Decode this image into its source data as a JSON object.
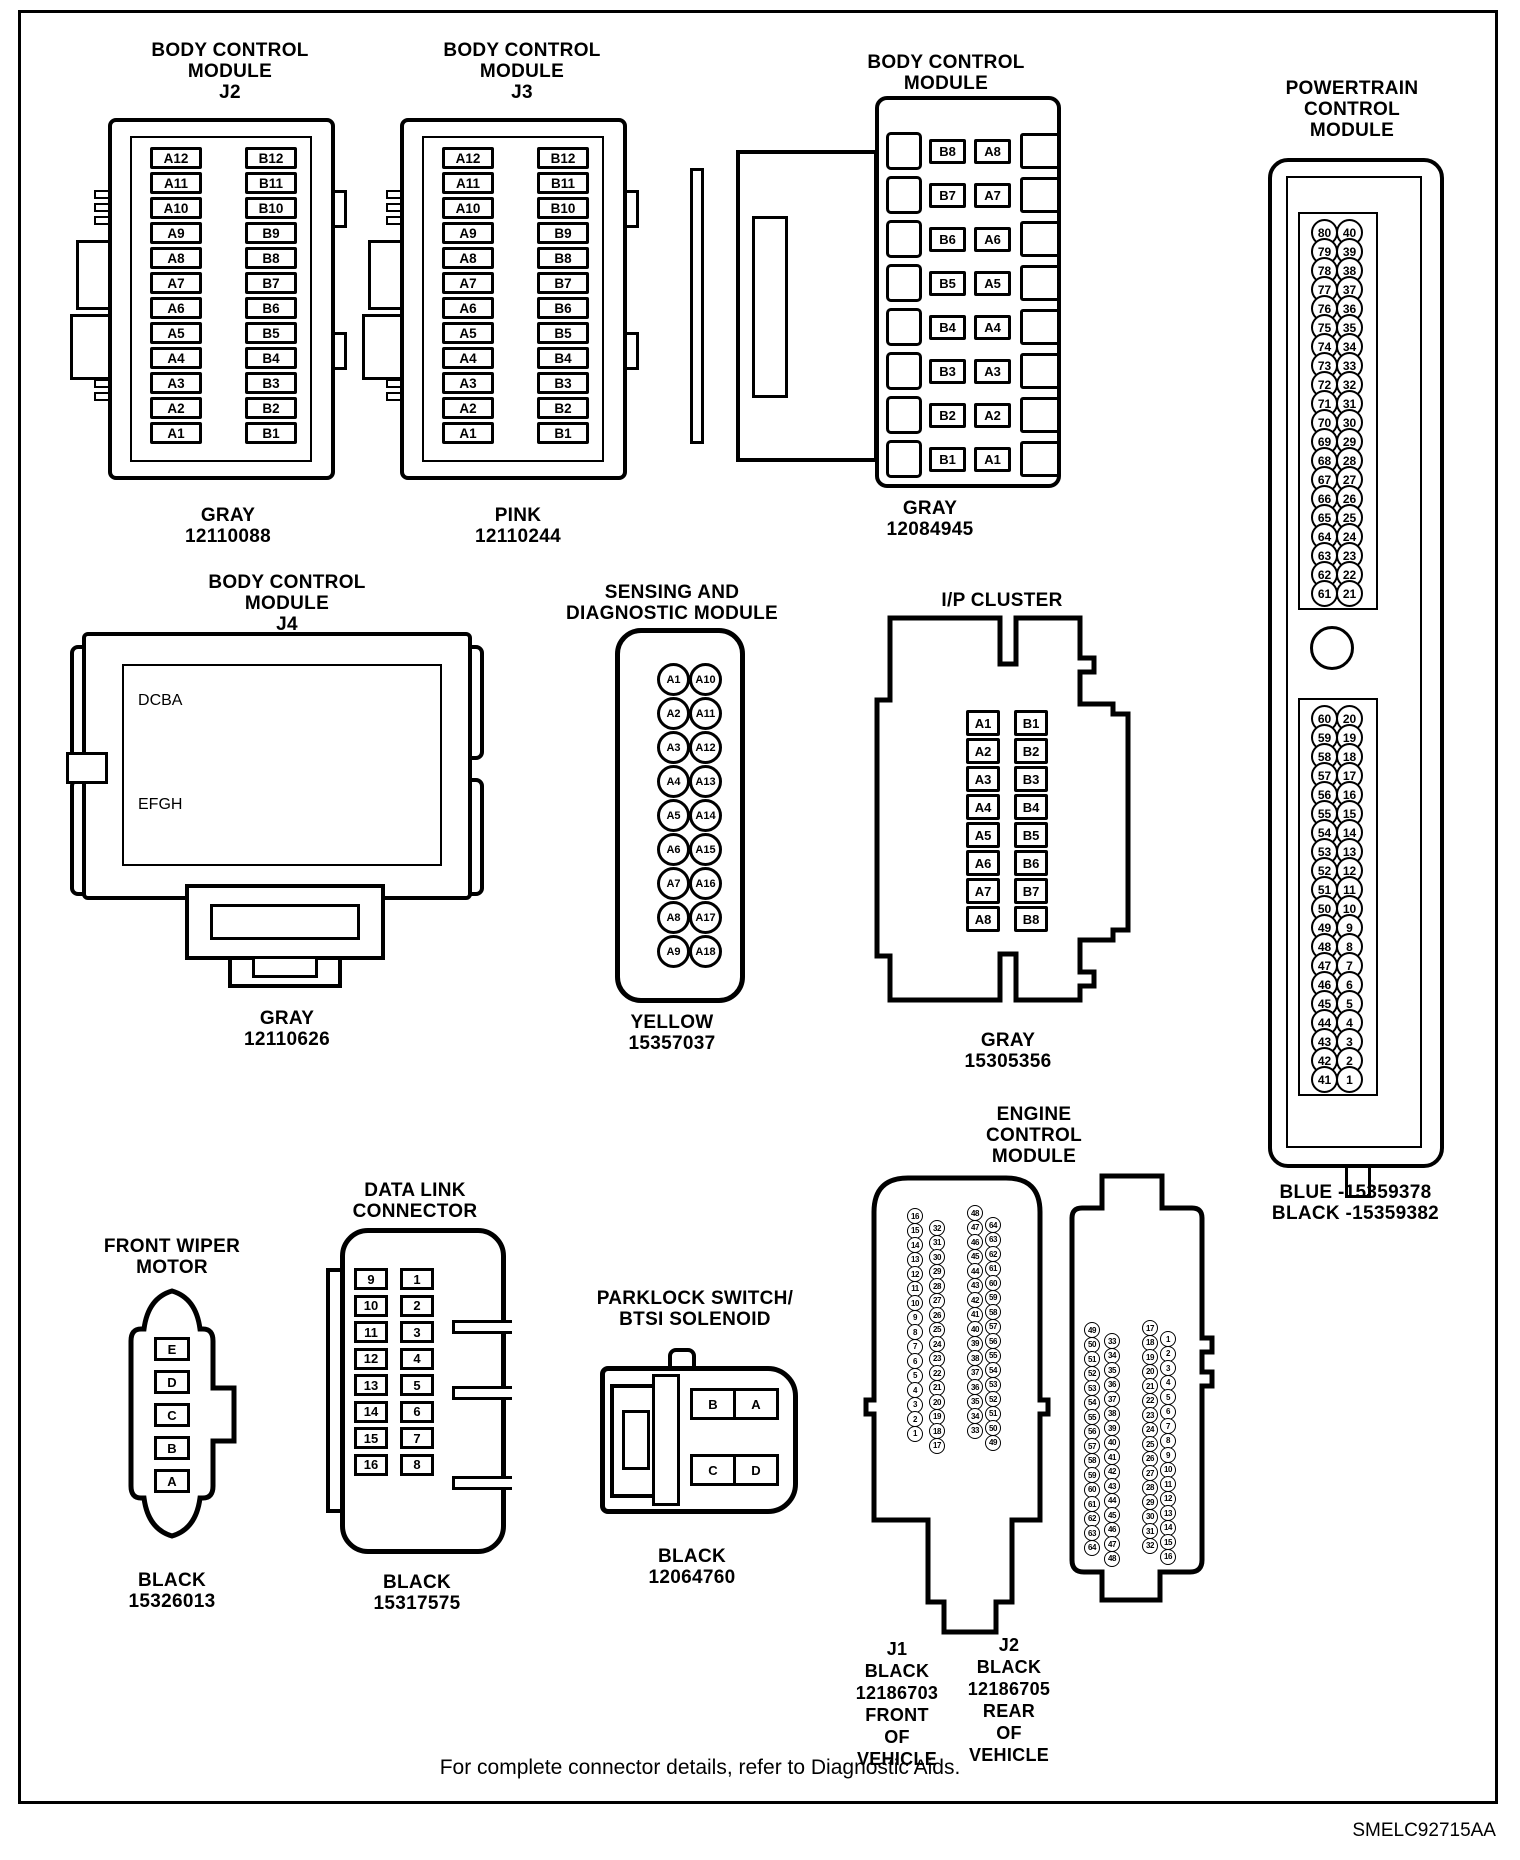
{
  "page": {
    "footer_note": "For complete connector details, refer to Diagnostic Aids.",
    "doc_code": "SMELC92715AA",
    "line_color": "#000000",
    "background_color": "#ffffff"
  },
  "connectors": {
    "bcm_j2": {
      "title": "BODY CONTROL\nMODULE\nJ2",
      "caption": "GRAY\n12110088",
      "col_a": [
        "A12",
        "A11",
        "A10",
        "A9",
        "A8",
        "A7",
        "A6",
        "A5",
        "A4",
        "A3",
        "A2",
        "A1"
      ],
      "col_b": [
        "B12",
        "B11",
        "B10",
        "B9",
        "B8",
        "B7",
        "B6",
        "B5",
        "B4",
        "B3",
        "B2",
        "B1"
      ]
    },
    "bcm_j3": {
      "title": "BODY CONTROL\nMODULE\nJ3",
      "caption": "PINK\n12110244",
      "col_a": [
        "A12",
        "A11",
        "A10",
        "A9",
        "A8",
        "A7",
        "A6",
        "A5",
        "A4",
        "A3",
        "A2",
        "A1"
      ],
      "col_b": [
        "B12",
        "B11",
        "B10",
        "B9",
        "B8",
        "B7",
        "B6",
        "B5",
        "B4",
        "B3",
        "B2",
        "B1"
      ]
    },
    "bcm_j1": {
      "title": "BODY CONTROL\nMODULE\nJ1",
      "caption": "GRAY\n12084945",
      "rows": [
        [
          "B8",
          "A8"
        ],
        [
          "B7",
          "A7"
        ],
        [
          "B6",
          "A6"
        ],
        [
          "B5",
          "A5"
        ],
        [
          "B4",
          "A4"
        ],
        [
          "B3",
          "A3"
        ],
        [
          "B2",
          "A2"
        ],
        [
          "B1",
          "A1"
        ]
      ]
    },
    "pcm": {
      "title": "POWERTRAIN\nCONTROL\nMODULE",
      "caption": "BLUE -15359378\nBLACK -15359382",
      "top_pairs": [
        [
          80,
          40
        ],
        [
          79,
          39
        ],
        [
          78,
          38
        ],
        [
          77,
          37
        ],
        [
          76,
          36
        ],
        [
          75,
          35
        ],
        [
          74,
          34
        ],
        [
          73,
          33
        ],
        [
          72,
          32
        ],
        [
          71,
          31
        ],
        [
          70,
          30
        ],
        [
          69,
          29
        ],
        [
          68,
          28
        ],
        [
          67,
          27
        ],
        [
          66,
          26
        ],
        [
          65,
          25
        ],
        [
          64,
          24
        ],
        [
          63,
          23
        ],
        [
          62,
          22
        ],
        [
          61,
          21
        ]
      ],
      "bottom_pairs": [
        [
          60,
          20
        ],
        [
          59,
          19
        ],
        [
          58,
          18
        ],
        [
          57,
          17
        ],
        [
          56,
          16
        ],
        [
          55,
          15
        ],
        [
          54,
          14
        ],
        [
          53,
          13
        ],
        [
          52,
          12
        ],
        [
          51,
          11
        ],
        [
          50,
          10
        ],
        [
          49,
          9
        ],
        [
          48,
          8
        ],
        [
          47,
          7
        ],
        [
          46,
          6
        ],
        [
          45,
          5
        ],
        [
          44,
          4
        ],
        [
          43,
          3
        ],
        [
          42,
          2
        ],
        [
          41,
          1
        ]
      ]
    },
    "bcm_j4": {
      "title": "BODY CONTROL\nMODULE\nJ4",
      "caption": "GRAY\n12110626",
      "row1": [
        "D",
        "C",
        "B",
        "A"
      ],
      "row2": [
        "E",
        "F",
        "G",
        "H"
      ]
    },
    "sdm": {
      "title": "SENSING AND\nDIAGNOSTIC MODULE",
      "caption": "YELLOW\n15357037",
      "pairs": [
        [
          "A1",
          "A10"
        ],
        [
          "A2",
          "A11"
        ],
        [
          "A3",
          "A12"
        ],
        [
          "A4",
          "A13"
        ],
        [
          "A5",
          "A14"
        ],
        [
          "A6",
          "A15"
        ],
        [
          "A7",
          "A16"
        ],
        [
          "A8",
          "A17"
        ],
        [
          "A9",
          "A18"
        ]
      ]
    },
    "ip_cluster": {
      "title": "I/P CLUSTER",
      "caption": "GRAY\n15305356",
      "col_a": [
        "A1",
        "A2",
        "A3",
        "A4",
        "A5",
        "A6",
        "A7",
        "A8"
      ],
      "col_b": [
        "B1",
        "B2",
        "B3",
        "B4",
        "B5",
        "B6",
        "B7",
        "B8"
      ]
    },
    "wiper": {
      "title": "FRONT WIPER\nMOTOR",
      "caption": "BLACK\n15326013",
      "pins": [
        "E",
        "D",
        "C",
        "B",
        "A"
      ]
    },
    "dlc": {
      "title": "DATA LINK\nCONNECTOR",
      "caption": "BLACK\n15317575",
      "col_left": [
        "9",
        "10",
        "11",
        "12",
        "13",
        "14",
        "15",
        "16"
      ],
      "col_right": [
        "1",
        "2",
        "3",
        "4",
        "5",
        "6",
        "7",
        "8"
      ]
    },
    "parklock": {
      "title": "PARKLOCK SWITCH/\nBTSI SOLENOID",
      "caption": "BLACK\n12064760",
      "rows": [
        [
          "B",
          "A"
        ],
        [
          "C",
          "D"
        ]
      ]
    },
    "ecm": {
      "title": "ENGINE\nCONTROL\nMODULE",
      "j1": {
        "caption": "J1\nBLACK\n12186703\nFRONT\nOF\nVEHICLE",
        "cols": [
          [
            16,
            15,
            14,
            13,
            12,
            11,
            10,
            9,
            8,
            7,
            6,
            5,
            4,
            3,
            2,
            1
          ],
          [
            32,
            31,
            30,
            29,
            28,
            27,
            26,
            25,
            24,
            23,
            22,
            21,
            20,
            19,
            18,
            17
          ],
          [
            48,
            47,
            46,
            45,
            44,
            43,
            42,
            41,
            40,
            39,
            38,
            37,
            36,
            35,
            34,
            33
          ],
          [
            64,
            63,
            62,
            61,
            60,
            59,
            58,
            57,
            56,
            55,
            54,
            53,
            52,
            51,
            50,
            49
          ]
        ]
      },
      "j2": {
        "caption": "J2\nBLACK\n12186705\nREAR\nOF\nVEHICLE",
        "cols": [
          [
            49,
            50,
            51,
            52,
            53,
            54,
            55,
            56,
            57,
            58,
            59,
            60,
            61,
            62,
            63,
            64
          ],
          [
            33,
            34,
            35,
            36,
            37,
            38,
            39,
            40,
            41,
            42,
            43,
            44,
            45,
            46,
            47,
            48
          ],
          [
            17,
            18,
            19,
            20,
            21,
            22,
            23,
            24,
            25,
            26,
            27,
            28,
            29,
            30,
            31,
            32
          ],
          [
            1,
            2,
            3,
            4,
            5,
            6,
            7,
            8,
            9,
            10,
            11,
            12,
            13,
            14,
            15,
            16
          ]
        ]
      }
    }
  }
}
